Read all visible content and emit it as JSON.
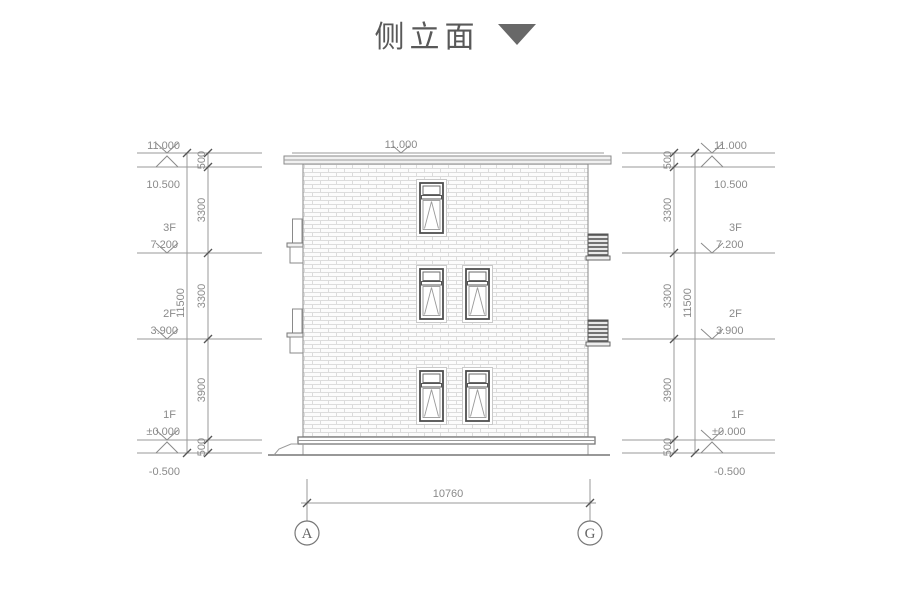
{
  "title": {
    "text": "侧立面"
  },
  "colors": {
    "line": "#9a9a9a",
    "dark_line": "#777777",
    "text": "#8a8a8a",
    "title_text": "#595959",
    "marker_triangle": "#686868",
    "brick_joint": "#dcdcdc"
  },
  "elevation_markers": {
    "parapet": {
      "floor": "",
      "value": "11.000"
    },
    "roof": {
      "floor": "",
      "value": "10.500"
    },
    "f3": {
      "floor": "3F",
      "value": "7.200"
    },
    "f2": {
      "floor": "2F",
      "value": "3.900"
    },
    "f1": {
      "floor": "1F",
      "value": "±0.000"
    },
    "base": {
      "floor": "",
      "value": "-0.500"
    }
  },
  "dimensions": {
    "segments": [
      "500",
      "3300",
      "3300",
      "3900",
      "500"
    ],
    "overall": "11500",
    "width": "10760",
    "roof_peak": "11.000"
  },
  "grid_axes": {
    "left": "A",
    "right": "G"
  }
}
